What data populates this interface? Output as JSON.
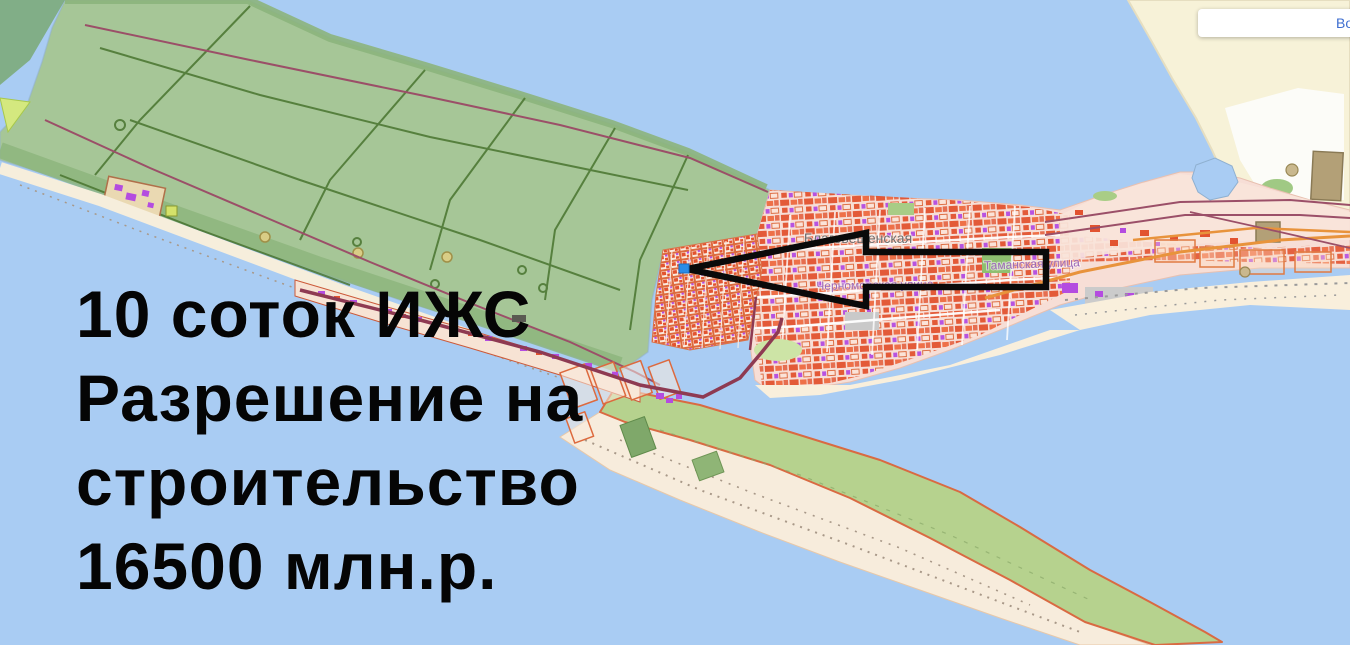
{
  "app": {
    "login_button": {
      "visible_text": "Во"
    }
  },
  "overlay": {
    "lines": [
      "10 соток ИЖС",
      "Разрешение на",
      "строительство",
      "16500 млн.р."
    ]
  },
  "map": {
    "type": "public-cadastral-map",
    "place_labels": [
      {
        "text": "Благовещенская",
        "kind": "settlement"
      },
      {
        "text": "Черноморская улица",
        "kind": "street"
      },
      {
        "text": "Таманская улица",
        "kind": "street"
      }
    ],
    "marker": {
      "shape": "square",
      "transform": "translate(679,264)"
    },
    "arrow": {
      "points": "687,269 866,233 866,252 1046,252 1046,287 866,287 866,306"
    }
  },
  "colors": {
    "water": "#a9ccf3",
    "kosa": "#a6c697",
    "kosaBand": "#8cb47c",
    "kosaDark": "#74a463",
    "pathLine": "#49742f",
    "maroon": "#9b4f68",
    "road": "#8e3a52",
    "settlement": "#f7ded6",
    "building": "#e25330",
    "buildingAlt": "#ee6a40",
    "purple": "#b44ce0",
    "gridLine": "#dd6a3e",
    "sand": "#f7ecdc",
    "beach": "#f6eedc",
    "spitGreen": "#b6d28e",
    "spitEdge": "#d96a42",
    "paleLand": "#f7f2d8",
    "tan": "#b3a077",
    "orangeRoad": "#e8933c",
    "greenPatch": "#8fbf70",
    "arrow": "#0a0a0a",
    "marker": "#2b8ce8",
    "labelGray": "#6f6f6f",
    "labelPurple": "#9d6ab8",
    "overlayText": "#050505",
    "loginBlue": "#3e6ed0",
    "boxWhite": "#ffffff"
  }
}
